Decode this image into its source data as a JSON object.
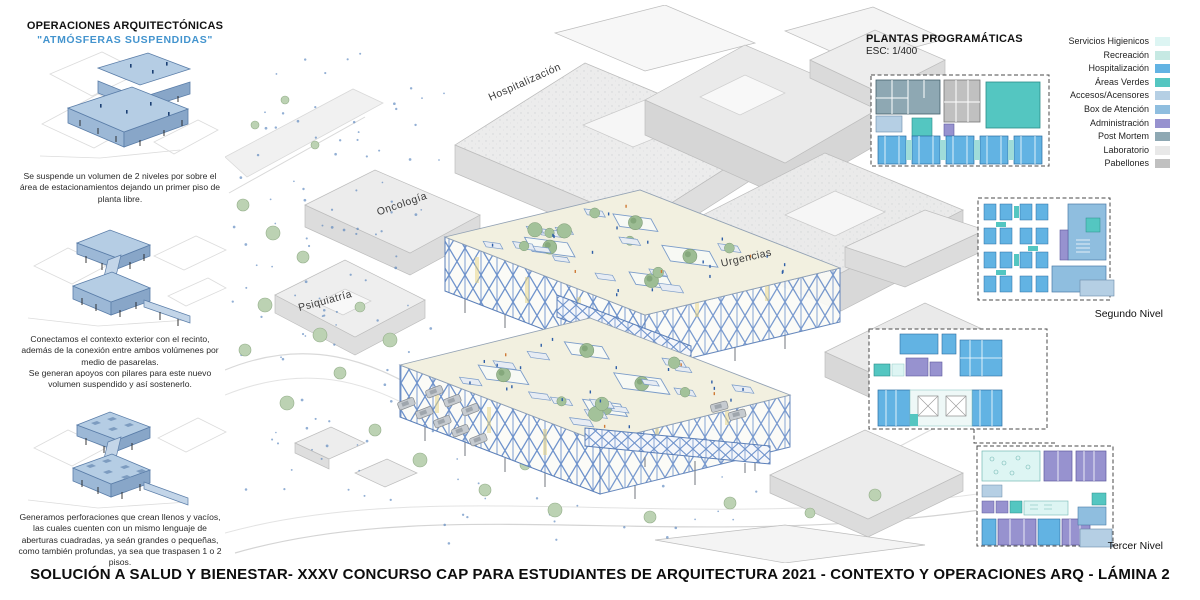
{
  "page": {
    "bottom_title": "SOLUCIÓN A SALUD Y BIENESTAR- XXXV CONCURSO CAP PARA ESTUDIANTES DE ARQUITECTURA 2021 - CONTEXTO Y OPERACIONES ARQ - LÁMINA 2"
  },
  "operations_panel": {
    "title": "OPERACIONES ARQUITECTÓNICAS",
    "subtitle": "\"ATMÓSFERAS SUSPENDIDAS\"",
    "steps": [
      {
        "text": "Se suspende un volumen de 2 niveles por sobre el área de estacionamientos dejando un primer piso de planta libre."
      },
      {
        "text": "Conectamos el contexto exterior con el recinto, además de la conexión entre ambos volúmenes por medio de pasarelas.\nSe generan apoyos con pilares para este nuevo volumen suspendido y así sostenerlo."
      },
      {
        "text": "Generamos perforaciones que crean llenos y vacíos, las cuales cuenten con un mismo lenguaje de aberturas cuadradas, ya seán grandes o pequeñas, como también profundas, ya sea que traspasen 1 o 2 pisos."
      }
    ]
  },
  "axon_labels": {
    "hospitalizacion": "Hospitalización",
    "oncologia": "Oncología",
    "urgencias": "Urgencias",
    "psiquiatria": "Psiquiatría"
  },
  "plans_panel": {
    "title": "PLANTAS PROGRAMÁTICAS",
    "scale": "ESC: 1/400",
    "second_level_label": "Segundo Nivel",
    "third_level_label": "Tercer Nivel"
  },
  "legend": {
    "items": [
      {
        "label": "Servicios Higienicos",
        "color": "#ddf5f3"
      },
      {
        "label": "Recreación",
        "color": "#c6e9e3"
      },
      {
        "label": "Hospitalización",
        "color": "#62b3e3"
      },
      {
        "label": "Áreas Verdes",
        "color": "#54c6c1"
      },
      {
        "label": "Accesos/Acensores",
        "color": "#b5cfe4"
      },
      {
        "label": "Box de Atención",
        "color": "#8fbedf"
      },
      {
        "label": "Administración",
        "color": "#9792cf"
      },
      {
        "label": "Post Mortem",
        "color": "#8ea8b3"
      },
      {
        "label": "Laboratorio",
        "color": "#e8e8e8"
      },
      {
        "label": "Pabellones",
        "color": "#c0c0c0"
      }
    ]
  }
}
